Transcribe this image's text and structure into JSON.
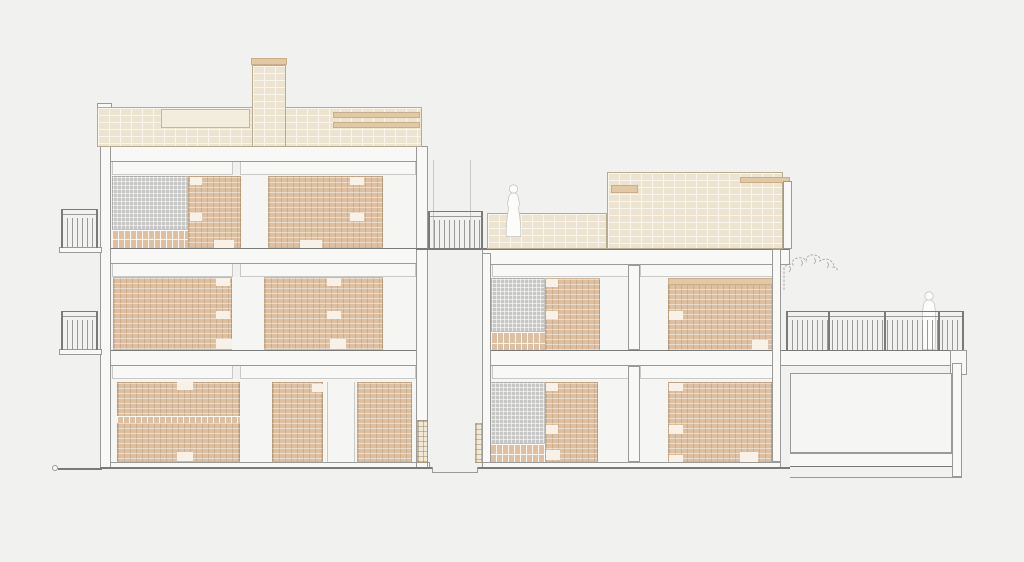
{
  "drawing": {
    "title_label": "",
    "type": "architectural-section-elevation",
    "colors": {
      "background": "#f1f1ef",
      "line": "#9a9a98",
      "line_dark": "#7a7a78",
      "line_light": "#c9c9c7",
      "wall_fill": "#f8f8f6",
      "room_fill": "#f5f5f3",
      "notch_fill": "#f7f1e7",
      "brick_light": "#ece3d1",
      "brick_joint": "#f9f5ec",
      "brick_edge": "#b7ab92",
      "brick_tan": "#dcc0a1",
      "band_tan": "#e0c9a4",
      "hatch_gray": "#c7c7c5",
      "figure_fill": "#fcfcfa",
      "figure_stroke": "#c6c6c4",
      "plant_stroke": "#a6a6a4"
    }
  },
  "scene": {
    "left_building": {
      "label": "left building block, 3 storeys with roof parapet and chimney",
      "floors": 3
    },
    "right_building": {
      "label": "right building block, 2 storeys with roof terrace parapet",
      "floors": 2
    },
    "figures": [
      {
        "label": "person standing on roof terrace"
      },
      {
        "label": "person standing on rear walkway"
      }
    ],
    "elements": {
      "chimney": "brick chimney",
      "terrace_railing": "stair terrace railing",
      "walkway_railing": "rear walkway railing",
      "balcony_upper": "upper left balcony",
      "balcony_lower": "lower left balcony",
      "plant": "climbing plant",
      "basement_room": "lower right room",
      "ground_line": "ground reference line"
    }
  }
}
